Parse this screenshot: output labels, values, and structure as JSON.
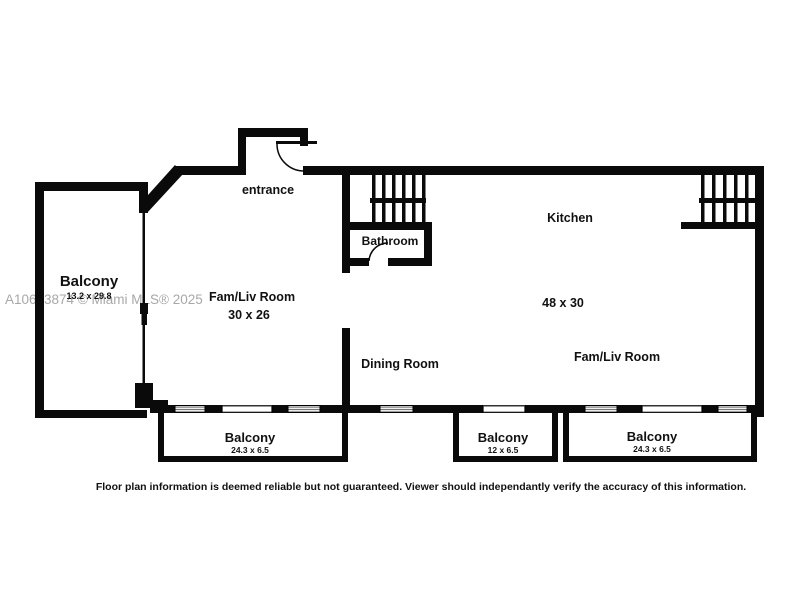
{
  "watermark": "A10653874 © Miami MLS® 2025",
  "disclaimer": "Floor plan information is deemed reliable but not guaranteed.  Viewer should independantly verify the accuracy of this information.",
  "labels": {
    "balcony_left": {
      "name": "Balcony",
      "dims": "13.2 x 29.8"
    },
    "entrance": "entrance",
    "bathroom": "Bathroom",
    "kitchen": "Kitchen",
    "famliv_left": {
      "name": "Fam/Liv Room",
      "dims": "30 x 26"
    },
    "main_dims": "48 x 30",
    "dining": "Dining Room",
    "famliv_right": "Fam/Liv Room",
    "balcony_bottom_left": {
      "name": "Balcony",
      "dims": "24.3 x 6.5"
    },
    "balcony_bottom_middle": {
      "name": "Balcony",
      "dims": "12 x 6.5"
    },
    "balcony_bottom_right": {
      "name": "Balcony",
      "dims": "24.3 x 6.5"
    }
  },
  "colors": {
    "wall": "#0a0a0a",
    "background": "#ffffff",
    "watermark": "#a8a8a8",
    "window_stripe": "#666666"
  }
}
